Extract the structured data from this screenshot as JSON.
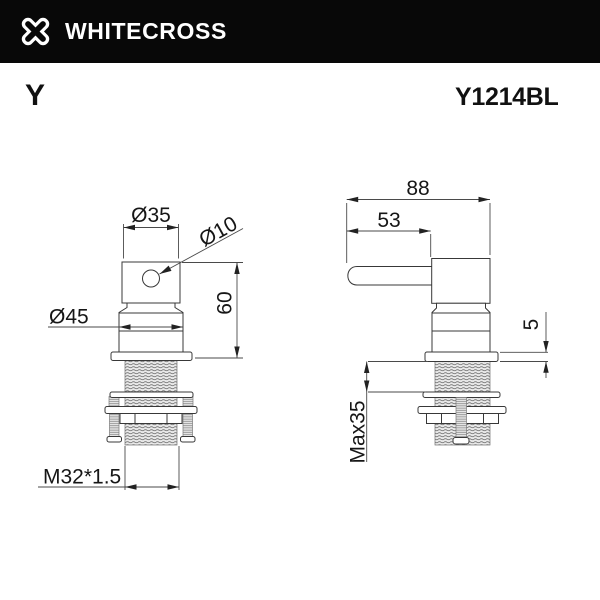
{
  "header": {
    "brand": "WHITECROSS",
    "background": "#080808",
    "foreground": "#ffffff"
  },
  "icons": {
    "logo": "whitecross-x-icon"
  },
  "product": {
    "series": "Y",
    "model": "Y1214BL"
  },
  "views": {
    "front": {
      "dimensions": {
        "handle_width": "Ø35",
        "pin_hole": "Ø10",
        "collar": "Ø45",
        "height": "60",
        "thread": "M32*1.5"
      }
    },
    "side": {
      "dimensions": {
        "depth": "88",
        "lever": "53",
        "plate": "5",
        "mount": "Max35"
      }
    }
  },
  "colors": {
    "outline": "#383838",
    "dimension": "#4a4a4a",
    "text": "#161616"
  }
}
